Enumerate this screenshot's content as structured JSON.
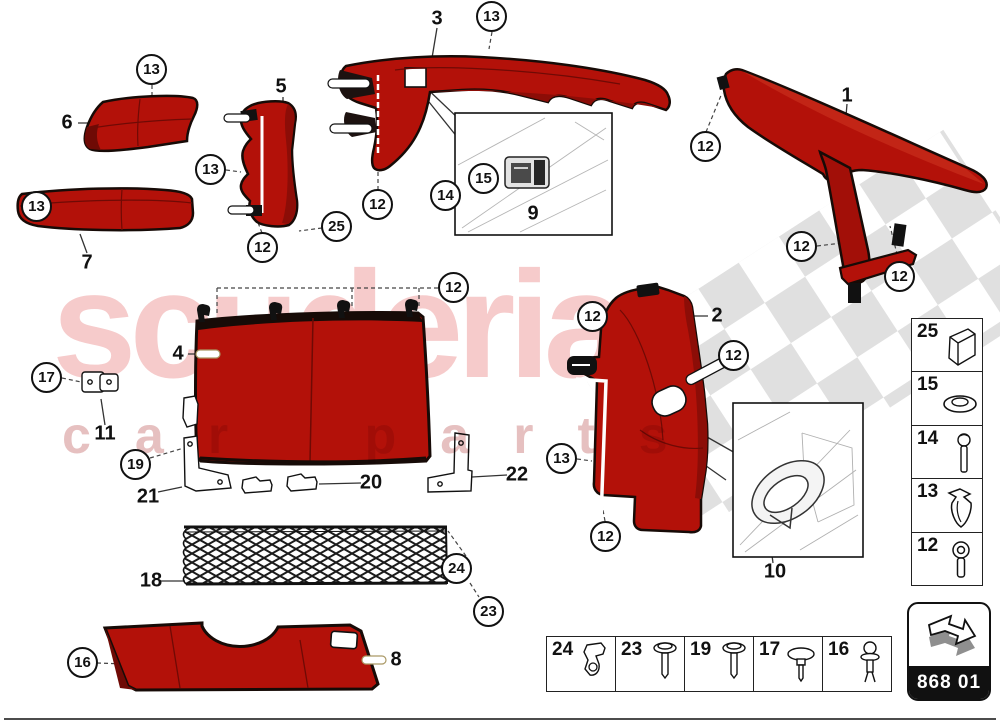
{
  "watermark": {
    "brand": "scuderia",
    "sub": "car parts",
    "brand_color": "#f6cbcb",
    "checker_color": "#dadada"
  },
  "colors": {
    "part_red": "#b31109",
    "part_dark_red": "#6f0a05",
    "outline": "#170b07"
  },
  "callouts": [
    "13",
    "13",
    "13",
    "12",
    "13",
    "25",
    "12",
    "14",
    "15",
    "12",
    "12",
    "12",
    "12",
    "17",
    "19",
    "12",
    "12",
    "13",
    "12",
    "24",
    "23",
    "16"
  ],
  "labels": [
    "6",
    "7",
    "5",
    "3",
    "9",
    "1",
    "4",
    "11",
    "21",
    "20",
    "22",
    "18",
    "8",
    "2",
    "10"
  ],
  "legend_right": {
    "rows": [
      {
        "num": "25",
        "icon": "foam-block"
      },
      {
        "num": "15",
        "icon": "washer"
      },
      {
        "num": "14",
        "icon": "bolt"
      },
      {
        "num": "13",
        "icon": "clip"
      },
      {
        "num": "12",
        "icon": "screw"
      }
    ]
  },
  "legend_bottom": {
    "cells": [
      {
        "num": "24",
        "icon": "bracket-clip"
      },
      {
        "num": "23",
        "icon": "screw"
      },
      {
        "num": "19",
        "icon": "screw"
      },
      {
        "num": "17",
        "icon": "push-rivet"
      },
      {
        "num": "16",
        "icon": "ball-stud"
      }
    ]
  },
  "badge": {
    "code": "868 01",
    "icon": "page-arrow"
  }
}
